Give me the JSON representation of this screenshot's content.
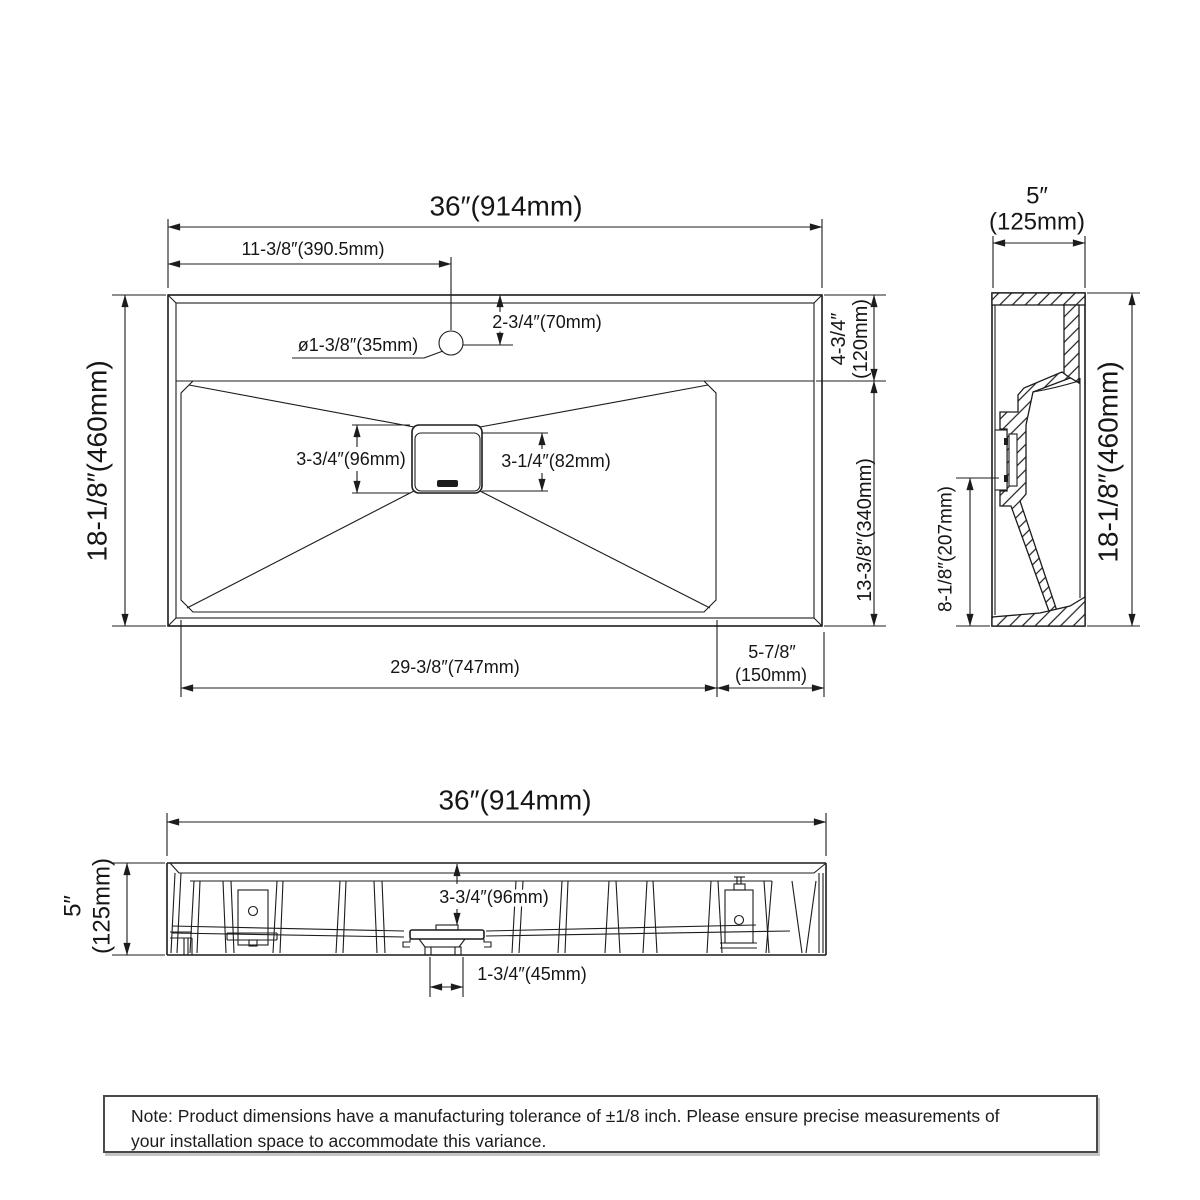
{
  "top": {
    "overall_width": "36″(914mm)",
    "overall_depth": "18-1/8″(460mm)",
    "faucet_from_left": "11-3/8″(390.5mm)",
    "faucet_setback": "2-3/4″(70mm)",
    "faucet_hole": "ø1-3/8″(35mm)",
    "deck_depth_in": "4-3/4″",
    "deck_depth_mm": "(120mm)",
    "basin_depth": "13-3/8″(340mm)",
    "drain_outer": "3-3/4″(96mm)",
    "drain_inner": "3-1/4″(82mm)",
    "basin_width": "29-3/8″(747mm)",
    "right_deck_in": "5-7/8″",
    "right_deck_mm": "(150mm)"
  },
  "side": {
    "depth_in": "5″",
    "depth_mm": "(125mm)",
    "overall_height": "18-1/8″(460mm)",
    "drain_center_height": "8-1/8″(207mm)"
  },
  "front": {
    "overall_width": "36″(914mm)",
    "height_in": "5″",
    "height_mm": "(125mm)",
    "drain_drop": "3-3/4″(96mm)",
    "drain_outlet": "1-3/4″(45mm)"
  },
  "note": {
    "line1": "Note: Product dimensions have a manufacturing tolerance of ±1/8 inch. Please ensure precise measurements of",
    "line2": "your installation space to accommodate this variance."
  },
  "colors": {
    "line": "#1c1c1c",
    "background": "#ffffff",
    "note_border": "#4a4a4a"
  }
}
